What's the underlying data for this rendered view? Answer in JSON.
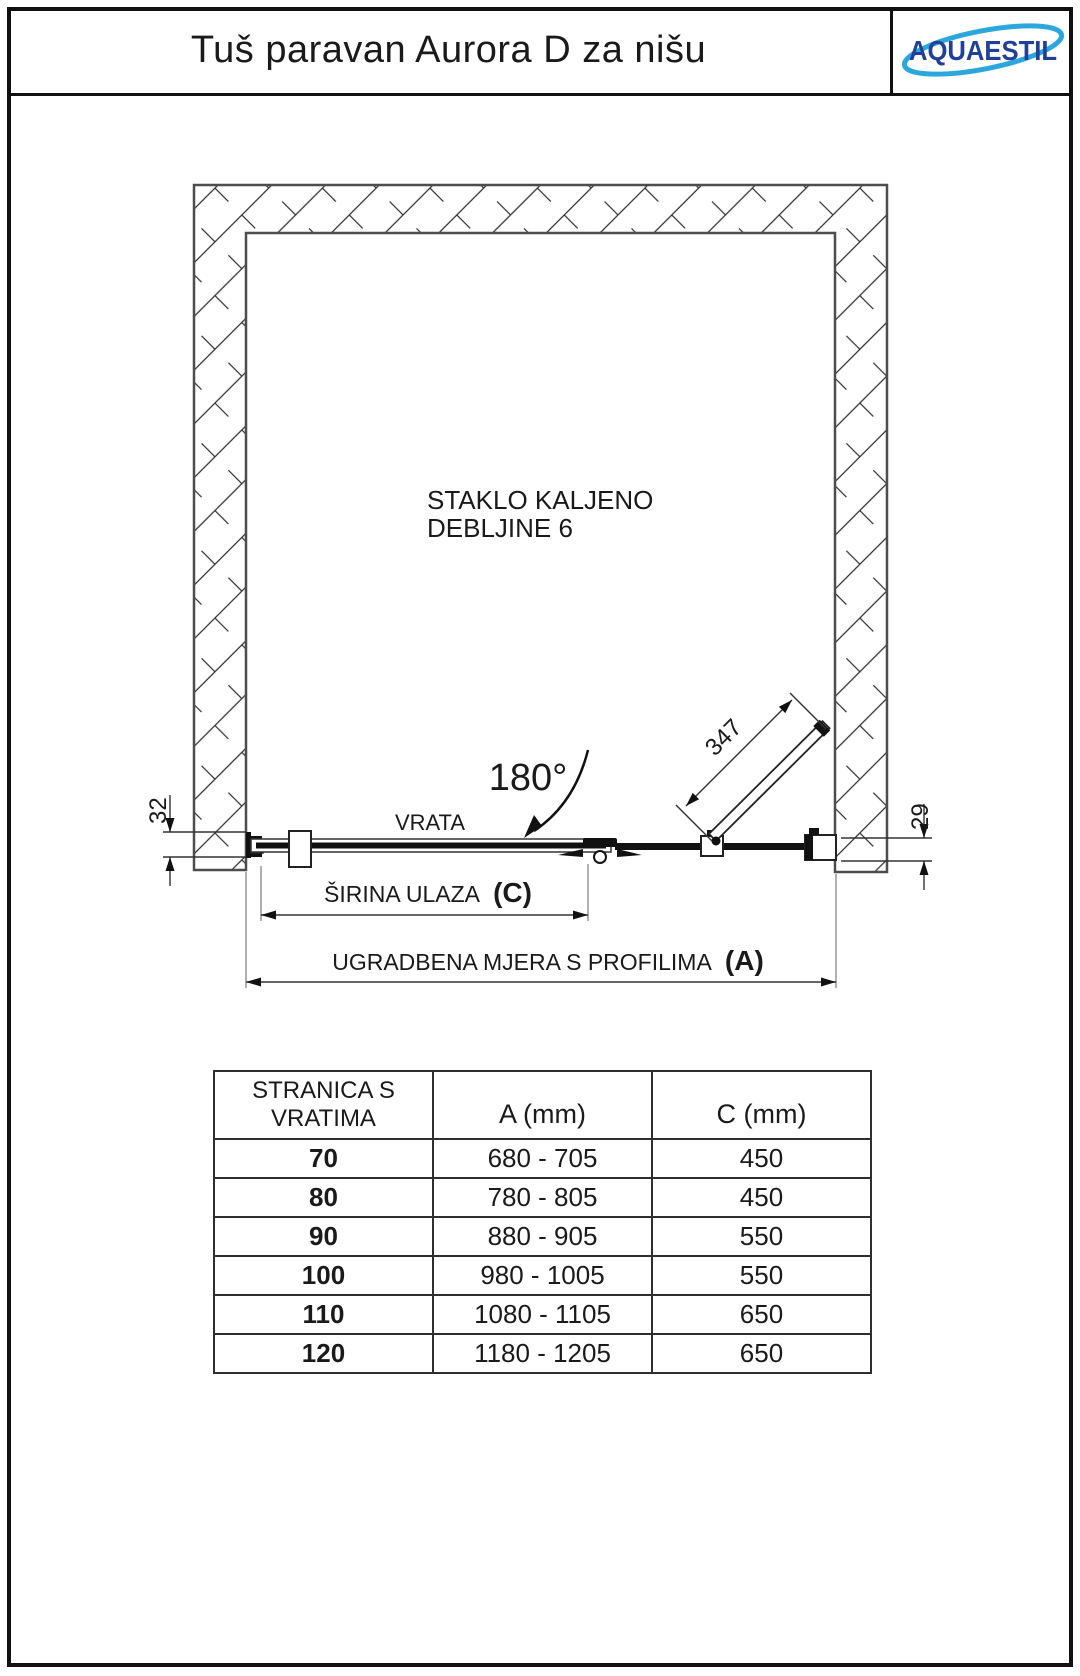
{
  "header": {
    "title": "Tuš paravan Aurora D za nišu",
    "logo_text": "AQUAESTIL"
  },
  "colors": {
    "logo_navy": "#21409a",
    "logo_cyan": "#2ba7de",
    "line_dark": "#1a1a1a",
    "wall_outline": "#4d4d4d"
  },
  "diagram": {
    "glass_note_line1": "STAKLO KALJENO",
    "glass_note_line2": "DEBLJINE 6",
    "door_label": "VRATA",
    "angle_label": "180°",
    "dim_left": "32",
    "dim_right": "29",
    "dim_diagonal": "347",
    "dim_entry_label": "ŠIRINA ULAZA",
    "dim_entry_symbol": "(C)",
    "dim_install_label": "UGRADBENA MJERA S PROFILIMA",
    "dim_install_symbol": "(A)"
  },
  "table": {
    "col1_header_line1": "STRANICA S",
    "col1_header_line2": "VRATIMA",
    "col2_header": "A (mm)",
    "col3_header": "C (mm)",
    "rows": [
      {
        "size": "70",
        "a": "680 - 705",
        "c": "450"
      },
      {
        "size": "80",
        "a": "780 - 805",
        "c": "450"
      },
      {
        "size": "90",
        "a": "880 - 905",
        "c": "550"
      },
      {
        "size": "100",
        "a": "980 - 1005",
        "c": "550"
      },
      {
        "size": "110",
        "a": "1080 - 1105",
        "c": "650"
      },
      {
        "size": "120",
        "a": "1180 - 1205",
        "c": "650"
      }
    ]
  }
}
